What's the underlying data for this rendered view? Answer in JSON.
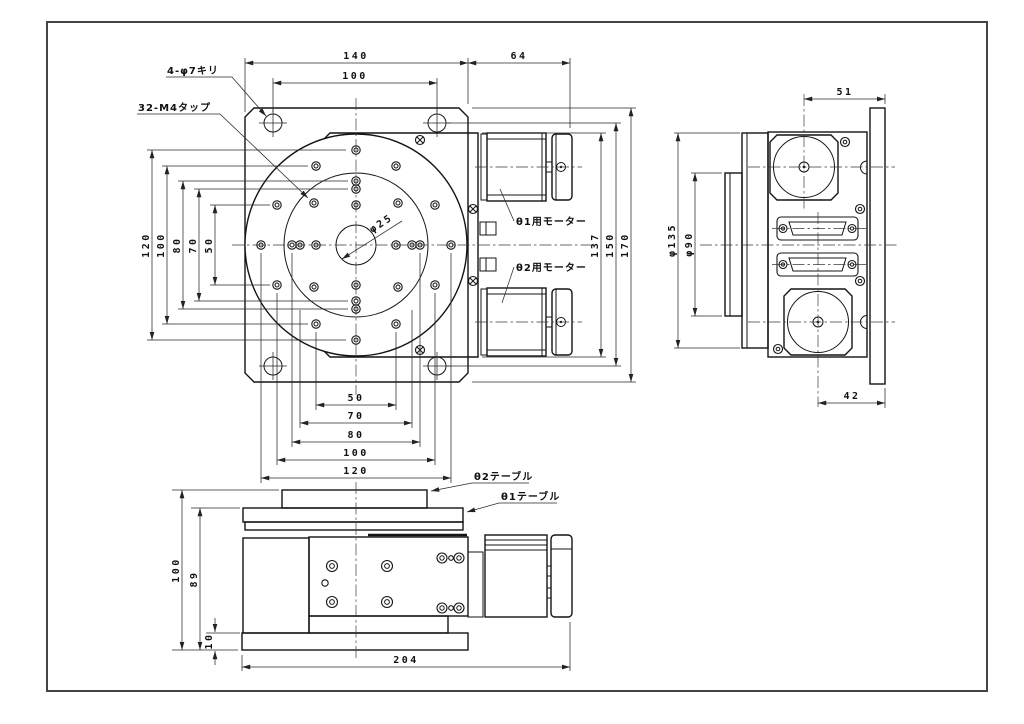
{
  "style": {
    "ink": "#141414",
    "background": "#ffffff"
  },
  "plan_view": {
    "callouts": {
      "drill": "4-φ7キリ",
      "tap": "32-M4タップ",
      "motor1": "θ1用モーター",
      "motor2": "θ2用モーター",
      "center_hole": "φ25"
    },
    "dims_top": [
      "140",
      "100",
      "64"
    ],
    "dims_left": [
      "120",
      "100",
      "80",
      "70",
      "50"
    ],
    "dims_bottom": [
      "50",
      "70",
      "80",
      "100",
      "120"
    ],
    "dims_right": [
      "137",
      "150",
      "170"
    ]
  },
  "side_view": {
    "dims": {
      "top": "51",
      "outer_dia": "φ135",
      "inner_dia": "φ90",
      "bottom": "42"
    }
  },
  "front_view": {
    "callouts": {
      "table2": "θ2テーブル",
      "table1": "θ1テーブル"
    },
    "dims_left": [
      "100",
      "89",
      "10"
    ],
    "dim_bottom": "204"
  }
}
